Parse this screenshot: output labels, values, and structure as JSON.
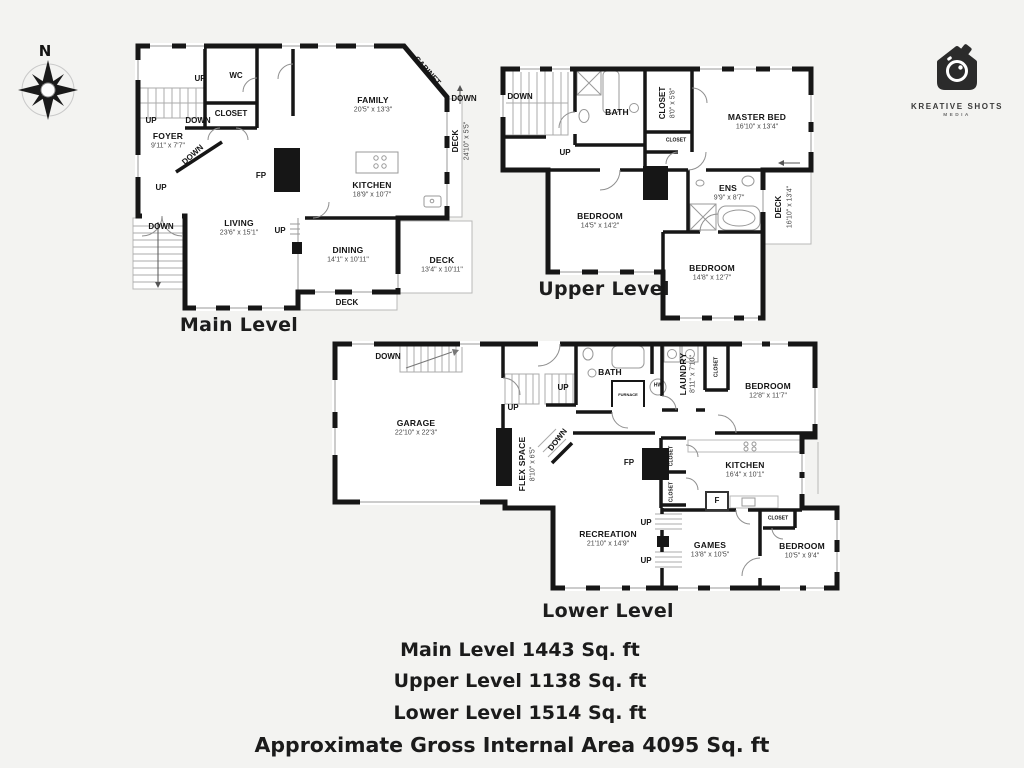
{
  "compass": {
    "north_label": "N"
  },
  "logo": {
    "brand": "KREATIVE SHOTS",
    "sub": "MEDIA",
    "icon": "camera-house-icon"
  },
  "colors": {
    "wall": "#161616",
    "thin": "#9a9a9a",
    "deck": "#b8b8b8",
    "text": "#141414",
    "dim": "#474747",
    "background": "#f3f3f1"
  },
  "levels": [
    {
      "id": "main",
      "title": "Main Level",
      "labels": [
        {
          "t": "UP",
          "x": 200,
          "y": 79,
          "k": "tag"
        },
        {
          "t": "WC",
          "x": 236,
          "y": 76,
          "k": "tag"
        },
        {
          "t": "CLOSET",
          "x": 231,
          "y": 114,
          "k": "tag"
        },
        {
          "t": "DOWN",
          "x": 198,
          "y": 121,
          "k": "tag"
        },
        {
          "t": "UP",
          "x": 151,
          "y": 121,
          "k": "tag"
        },
        {
          "t": "FOYER",
          "x": 168,
          "y": 136,
          "k": "room"
        },
        {
          "t": "9'11\" x 7'7\"",
          "x": 168,
          "y": 146,
          "k": "dim"
        },
        {
          "t": "DOWN",
          "x": 193,
          "y": 155,
          "r": -42,
          "k": "tag"
        },
        {
          "t": "UP",
          "x": 161,
          "y": 188,
          "k": "tag"
        },
        {
          "t": "DOWN",
          "x": 161,
          "y": 227,
          "k": "tag"
        },
        {
          "t": "FP",
          "x": 261,
          "y": 176,
          "k": "tag"
        },
        {
          "t": "FAMILY",
          "x": 373,
          "y": 100,
          "k": "room"
        },
        {
          "t": "20'5\" x 13'3\"",
          "x": 373,
          "y": 110,
          "k": "dim"
        },
        {
          "t": "CABINET",
          "x": 427,
          "y": 71,
          "r": 48,
          "k": "tag"
        },
        {
          "t": "DOWN",
          "x": 464,
          "y": 99,
          "k": "tag"
        },
        {
          "t": "DECK",
          "x": 456,
          "y": 141,
          "r": -90,
          "k": "tag"
        },
        {
          "t": "24'10\" x 5'5\"",
          "x": 467,
          "y": 141,
          "r": -90,
          "k": "dim"
        },
        {
          "t": "KITCHEN",
          "x": 372,
          "y": 185,
          "k": "room"
        },
        {
          "t": "18'9\" x 10'7\"",
          "x": 372,
          "y": 195,
          "k": "dim"
        },
        {
          "t": "LIVING",
          "x": 239,
          "y": 223,
          "k": "room"
        },
        {
          "t": "23'6\" x 15'1\"",
          "x": 239,
          "y": 233,
          "k": "dim"
        },
        {
          "t": "UP",
          "x": 280,
          "y": 231,
          "k": "tag"
        },
        {
          "t": "DINING",
          "x": 348,
          "y": 250,
          "k": "room"
        },
        {
          "t": "14'1\" x 10'11\"",
          "x": 348,
          "y": 260,
          "k": "dim"
        },
        {
          "t": "DECK",
          "x": 442,
          "y": 260,
          "k": "room"
        },
        {
          "t": "13'4\" x 10'11\"",
          "x": 442,
          "y": 270,
          "k": "dim"
        },
        {
          "t": "DECK",
          "x": 347,
          "y": 303,
          "k": "tag"
        }
      ]
    },
    {
      "id": "upper",
      "title": "Upper Level",
      "labels": [
        {
          "t": "DOWN",
          "x": 520,
          "y": 97,
          "k": "tag"
        },
        {
          "t": "BATH",
          "x": 617,
          "y": 112,
          "k": "room"
        },
        {
          "t": "CLOSET",
          "x": 663,
          "y": 103,
          "r": -90,
          "k": "tag"
        },
        {
          "t": "8'0\" x 5'8\"",
          "x": 673,
          "y": 103,
          "r": -90,
          "k": "dim"
        },
        {
          "t": "MASTER BED",
          "x": 757,
          "y": 117,
          "k": "room"
        },
        {
          "t": "16'10\" x 13'4\"",
          "x": 757,
          "y": 127,
          "k": "dim"
        },
        {
          "t": "CLOSET",
          "x": 676,
          "y": 141,
          "k": "tiny"
        },
        {
          "t": "UP",
          "x": 565,
          "y": 153,
          "k": "tag"
        },
        {
          "t": "BEDROOM",
          "x": 600,
          "y": 216,
          "k": "room"
        },
        {
          "t": "14'5\" x 14'2\"",
          "x": 600,
          "y": 226,
          "k": "dim"
        },
        {
          "t": "ENS",
          "x": 728,
          "y": 188,
          "k": "room"
        },
        {
          "t": "9'9\" x 8'7\"",
          "x": 729,
          "y": 198,
          "k": "dim"
        },
        {
          "t": "DECK",
          "x": 779,
          "y": 207,
          "r": -90,
          "k": "tag"
        },
        {
          "t": "16'10\" x 13'4\"",
          "x": 790,
          "y": 207,
          "r": -90,
          "k": "dim"
        },
        {
          "t": "BEDROOM",
          "x": 712,
          "y": 268,
          "k": "room"
        },
        {
          "t": "14'8\" x 12'7\"",
          "x": 712,
          "y": 278,
          "k": "dim"
        }
      ]
    },
    {
      "id": "lower",
      "title": "Lower Level",
      "labels": [
        {
          "t": "DOWN",
          "x": 388,
          "y": 357,
          "k": "tag"
        },
        {
          "t": "GARAGE",
          "x": 416,
          "y": 423,
          "k": "room"
        },
        {
          "t": "22'10\" x 22'3\"",
          "x": 416,
          "y": 433,
          "k": "dim"
        },
        {
          "t": "UP",
          "x": 563,
          "y": 388,
          "k": "tag"
        },
        {
          "t": "UP",
          "x": 513,
          "y": 408,
          "k": "tag"
        },
        {
          "t": "BATH",
          "x": 610,
          "y": 372,
          "k": "room"
        },
        {
          "t": "FURNACE",
          "x": 628,
          "y": 395,
          "k": "tiny2"
        },
        {
          "t": "HW",
          "x": 658,
          "y": 386,
          "k": "tiny"
        },
        {
          "t": "LAUNDRY",
          "x": 683,
          "y": 374,
          "r": -90,
          "k": "room"
        },
        {
          "t": "8'11\" x 7'10\"",
          "x": 693,
          "y": 374,
          "r": -90,
          "k": "dim"
        },
        {
          "t": "CLOSET",
          "x": 717,
          "y": 367,
          "r": -90,
          "k": "tiny"
        },
        {
          "t": "BEDROOM",
          "x": 768,
          "y": 386,
          "k": "room"
        },
        {
          "t": "12'8\" x 11'7\"",
          "x": 768,
          "y": 396,
          "k": "dim"
        },
        {
          "t": "FLEX SPACE",
          "x": 522,
          "y": 464,
          "r": -90,
          "k": "room"
        },
        {
          "t": "8'10\" x 6'5\"",
          "x": 533,
          "y": 464,
          "r": -90,
          "k": "dim"
        },
        {
          "t": "DOWN",
          "x": 558,
          "y": 440,
          "r": -52,
          "k": "tag"
        },
        {
          "t": "FP",
          "x": 629,
          "y": 463,
          "k": "tag"
        },
        {
          "t": "CLOSET",
          "x": 672,
          "y": 456,
          "r": -90,
          "k": "tiny"
        },
        {
          "t": "CLOSET",
          "x": 672,
          "y": 492,
          "r": -90,
          "k": "tiny"
        },
        {
          "t": "KITCHEN",
          "x": 745,
          "y": 465,
          "k": "room"
        },
        {
          "t": "16'4\" x 10'1\"",
          "x": 745,
          "y": 475,
          "k": "dim"
        },
        {
          "t": "F",
          "x": 717,
          "y": 501,
          "k": "tag"
        },
        {
          "t": "UP",
          "x": 646,
          "y": 523,
          "k": "tag"
        },
        {
          "t": "UP",
          "x": 646,
          "y": 561,
          "k": "tag"
        },
        {
          "t": "RECREATION",
          "x": 608,
          "y": 534,
          "k": "room"
        },
        {
          "t": "21'10\" x 14'9\"",
          "x": 608,
          "y": 544,
          "k": "dim"
        },
        {
          "t": "GAMES",
          "x": 710,
          "y": 545,
          "k": "room"
        },
        {
          "t": "13'8\" x 10'5\"",
          "x": 710,
          "y": 555,
          "k": "dim"
        },
        {
          "t": "CLOSET",
          "x": 778,
          "y": 519,
          "k": "tiny"
        },
        {
          "t": "BEDROOM",
          "x": 802,
          "y": 546,
          "k": "room"
        },
        {
          "t": "10'5\" x 9'4\"",
          "x": 802,
          "y": 556,
          "k": "dim"
        }
      ]
    }
  ],
  "summary": {
    "lines": [
      "Main Level 1443 Sq. ft",
      "Upper Level 1138 Sq. ft",
      "Lower Level 1514 Sq. ft"
    ],
    "total": "Approximate Gross Internal Area 4095 Sq. ft"
  }
}
